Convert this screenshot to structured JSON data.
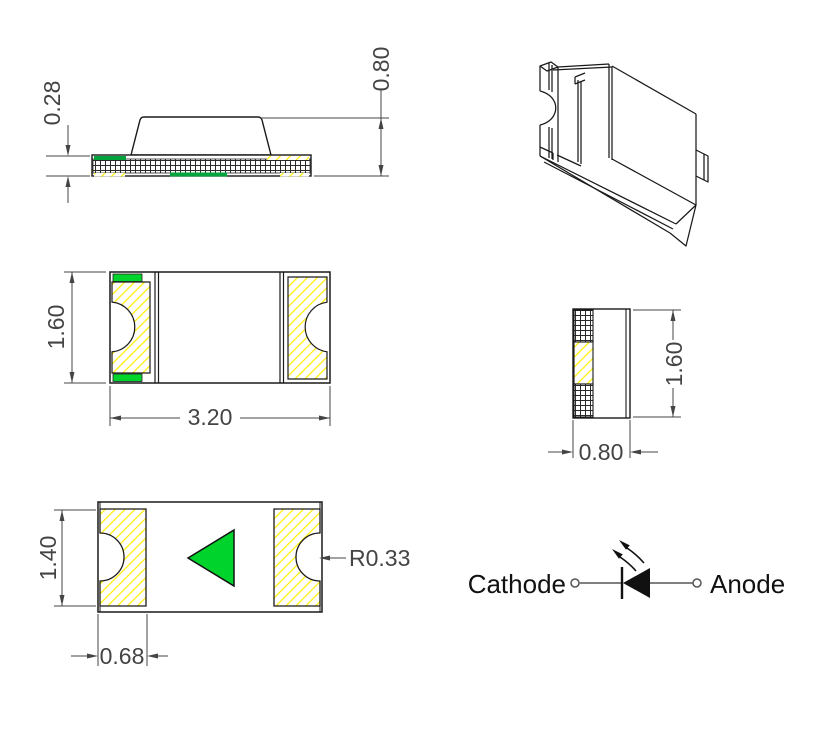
{
  "drawing": {
    "title": "smd-led-package-mechanical-drawing",
    "colors": {
      "green": "#00d42c",
      "green_dark": "#00a33c",
      "yellow": "#ffee00",
      "line": "#1a1a1a",
      "dim": "#444444",
      "wire": "#808080"
    },
    "views": {
      "side": {
        "dim_thickness": "0.28",
        "dim_height": "0.80"
      },
      "top": {
        "dim_height": "1.60",
        "dim_width": "3.20"
      },
      "end": {
        "dim_height": "1.60",
        "dim_width": "0.80"
      },
      "bottom": {
        "dim_pad_height": "1.40",
        "dim_pad_width": "0.68",
        "dim_notch_radius": "R0.33"
      },
      "schematic": {
        "cathode_label": "Cathode",
        "anode_label": "Anode"
      }
    }
  }
}
